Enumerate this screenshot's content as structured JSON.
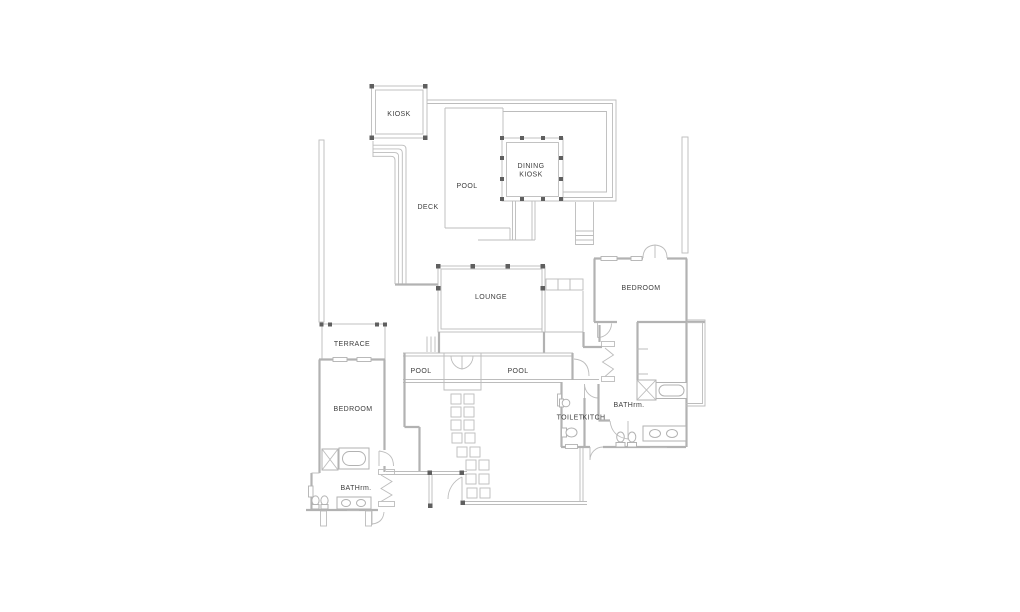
{
  "plan": {
    "labels": {
      "kiosk": "KIOSK",
      "pool_upper": "POOL",
      "deck": "DECK",
      "dining_line1": "DINING",
      "dining_line2": "KIOSK",
      "lounge": "LOUNGE",
      "bedroom_right": "BEDROOM",
      "terrace": "TERRACE",
      "bedroom_left": "BEDROOM",
      "pool_left": "POOL",
      "pool_right": "POOL",
      "toilet": "TOILET",
      "kitchen": "KITCH",
      "bathroom_right": "BATHrm.",
      "bathroom_left": "BATHrm."
    },
    "colors": {
      "wall": "#b2b2b2",
      "post": "#5f5f5f",
      "text": "#3d3d3d",
      "background": "#ffffff"
    }
  }
}
